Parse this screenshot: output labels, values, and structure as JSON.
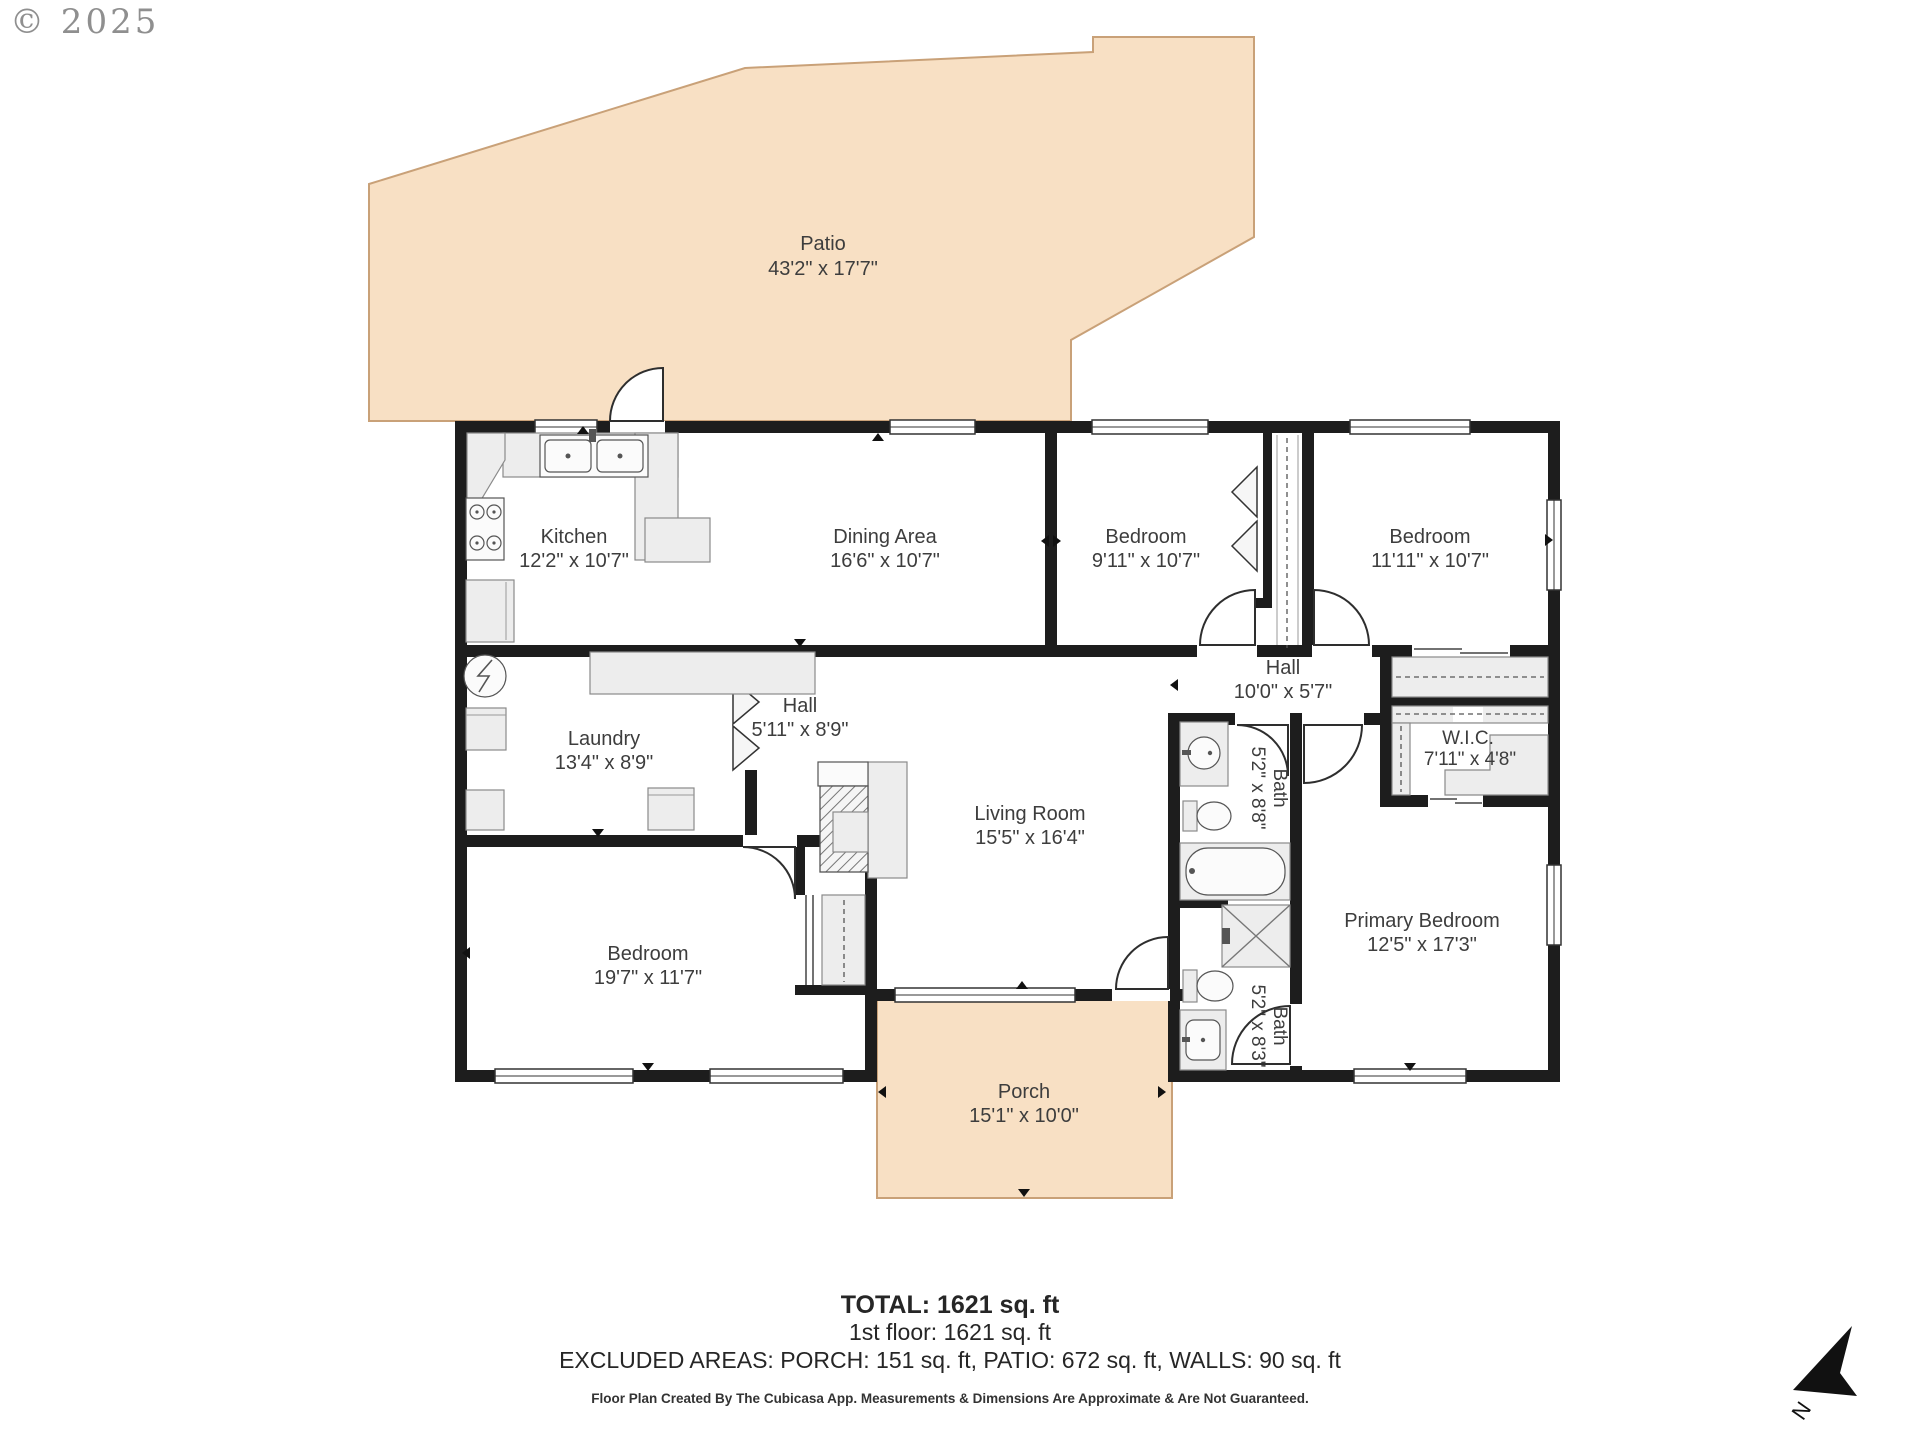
{
  "meta": {
    "copyright": "© 2025",
    "compass_label": "N"
  },
  "colors": {
    "outdoor_fill": "#f8e0c4",
    "outdoor_border": "#c9a178",
    "wall": "#1d1d1d",
    "fixture_fill": "#ededed",
    "label_text": "#3d3d3d"
  },
  "rooms": {
    "patio": {
      "name": "Patio",
      "dims": "43'2\" x 17'7\""
    },
    "kitchen": {
      "name": "Kitchen",
      "dims": "12'2\" x 10'7\""
    },
    "dining": {
      "name": "Dining Area",
      "dims": "16'6\" x 10'7\""
    },
    "bedroom1": {
      "name": "Bedroom",
      "dims": "9'11\" x 10'7\""
    },
    "bedroom2": {
      "name": "Bedroom",
      "dims": "11'11\" x 10'7\""
    },
    "laundry": {
      "name": "Laundry",
      "dims": "13'4\" x 8'9\""
    },
    "hall_upper": {
      "name": "Hall",
      "dims": "5'11\" x 8'9\""
    },
    "hall_lower": {
      "name": "Hall",
      "dims": "10'0\" x 5'7\""
    },
    "living": {
      "name": "Living Room",
      "dims": "15'5\" x 16'4\""
    },
    "wic": {
      "name": "W.I.C.",
      "dims": "7'11\" x 4'8\""
    },
    "bath_hall": {
      "name": "Bath",
      "dims": "5'2\" x 8'8\""
    },
    "bath_primary": {
      "name": "Bath",
      "dims": "5'2\" x 8'3\""
    },
    "bedroom3": {
      "name": "Bedroom",
      "dims": "19'7\" x 11'7\""
    },
    "primary": {
      "name": "Primary Bedroom",
      "dims": "12'5\" x 17'3\""
    },
    "porch": {
      "name": "Porch",
      "dims": "15'1\" x 10'0\""
    }
  },
  "summary": {
    "total": "TOTAL: 1621 sq. ft",
    "first_floor": "1st floor: 1621 sq. ft",
    "excluded": "EXCLUDED AREAS: PORCH: 151 sq. ft, PATIO: 672 sq. ft, WALLS: 90 sq. ft",
    "disclaimer": "Floor Plan Created By The Cubicasa App. Measurements & Dimensions Are Approximate & Are Not Guaranteed."
  }
}
